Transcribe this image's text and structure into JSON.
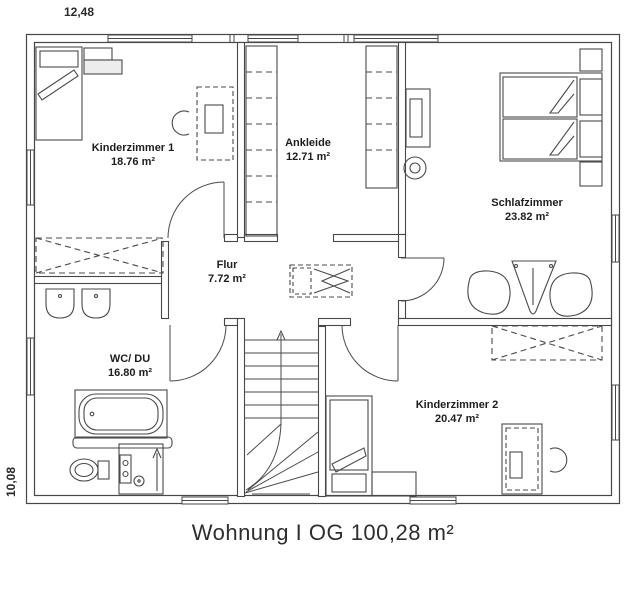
{
  "plan": {
    "caption": "Wohnung I OG 100,28 m²",
    "dimension_top": "12,48",
    "dimension_left": "10,08"
  },
  "rooms": [
    {
      "name": "Kinderzimmer 1",
      "area": "18.76 m²"
    },
    {
      "name": "Ankleide",
      "area": "12.71 m²"
    },
    {
      "name": "Schlafzimmer",
      "area": "23.82 m²"
    },
    {
      "name": "Flur",
      "area": "7.72 m²"
    },
    {
      "name": "WC/ DU",
      "area": "16.80 m²"
    },
    {
      "name": "Kinderzimmer 2",
      "area": "20.47 m²"
    }
  ],
  "colors": {
    "wall_line": "#474747",
    "furniture_line": "#4a4a4a",
    "label_text": "#1d1d1d",
    "caption_text": "#2e2e2e",
    "background": "#ffffff"
  }
}
